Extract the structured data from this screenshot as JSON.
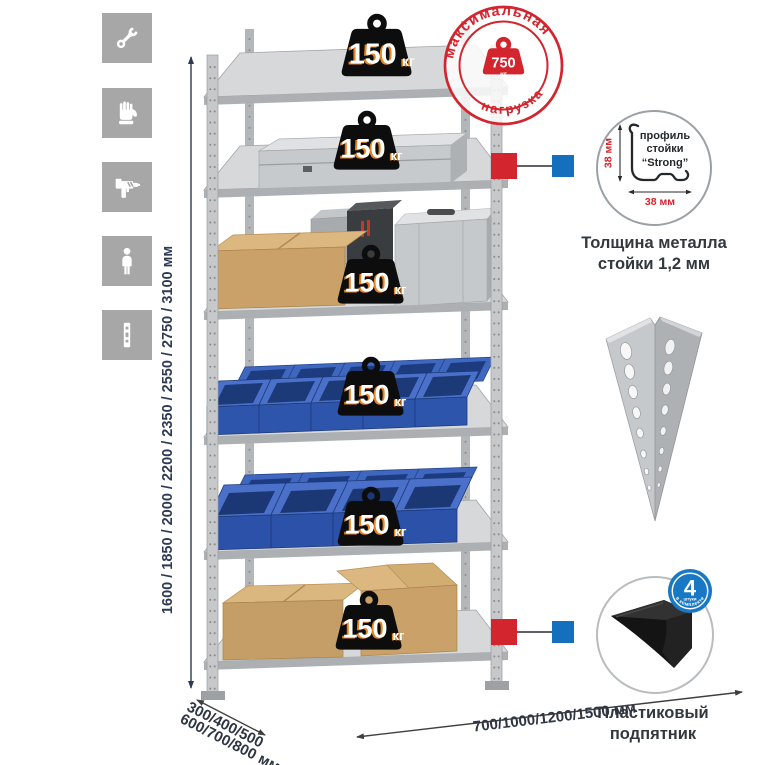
{
  "colors": {
    "accent_red": "#d2252d",
    "accent_blue": "#1470bd",
    "icon_bg": "#a7a7a7",
    "dim_text": "#2e3a55",
    "metal_gray": "#c6c9cc",
    "bin_blue": "#2e55ac",
    "cardboard_tan": "#c9a169"
  },
  "left_icons": [
    {
      "name": "wrench-icon"
    },
    {
      "name": "gloves-icon"
    },
    {
      "name": "drill-icon"
    },
    {
      "name": "person-height-icon"
    },
    {
      "name": "rack-post-icon"
    }
  ],
  "height_dim": {
    "label": "1600 / 1850 / 2000 / 2200 / 2350 / 2550 / 2750 / 3100 мм"
  },
  "shelf_weight": {
    "value": "150",
    "unit": "кг"
  },
  "stamp": {
    "arc_top": "максимальная",
    "arc_bottom": "нагрузка",
    "value": "750",
    "unit": "кг"
  },
  "profile_callout": {
    "line1": "профиль",
    "line2": "стойки",
    "line3": "“Strong”",
    "dim_vertical": "38 мм",
    "dim_horizontal": "38 мм",
    "caption1": "Толщина металла",
    "caption2": "стойки 1,2 мм"
  },
  "foot_callout": {
    "badge_value": "4",
    "badge_sub": "штуки",
    "badge_arc": "в комплекте",
    "caption1": "Пластиковый",
    "caption2": "подпятник"
  },
  "depth_dim": {
    "line1": "300/400/500",
    "line2": "600/700/800 мм"
  },
  "width_dim": {
    "label": "700/1000/1200/1500 мм"
  }
}
